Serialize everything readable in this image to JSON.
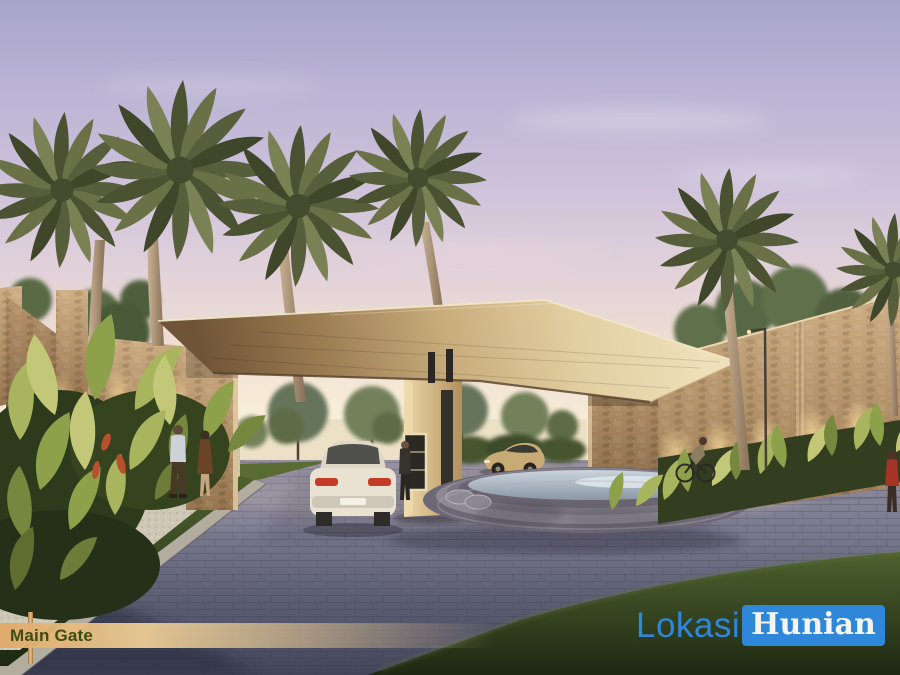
{
  "image": {
    "type": "architectural-rendering",
    "subject": "Residential estate main gate at dusk: flat wood canopy on stone pillars, palm trees, tropical planting, circular fountain, two cars, pedestrians and cyclist"
  },
  "caption_banner": {
    "label": "Main Gate"
  },
  "watermark": {
    "prefix": "Lokasi",
    "suffix": "Hunian"
  },
  "palette": {
    "sky_top": "#a8a4ca",
    "sky_horizon": "#f6ead6",
    "canopy_wood_light": "#eee0ba",
    "canopy_wood_shadow": "#6f5437",
    "stone_wall": "#c2a077",
    "foliage_yellow_green": "#a9b45e",
    "palm_frond": "#575e3b",
    "road_paver": "#6e7185",
    "foreground_grass": "#3b4c24",
    "fountain_water": "#c6d1da",
    "banner_gold": "#e2b478",
    "banner_text": "#3e4d13",
    "watermark_blue": "#2e87d8",
    "watermark_text": "#f4f4f0",
    "car_white": "#e9e2d2",
    "car_tan": "#c8ab74",
    "taillight_red": "#c33b28"
  }
}
